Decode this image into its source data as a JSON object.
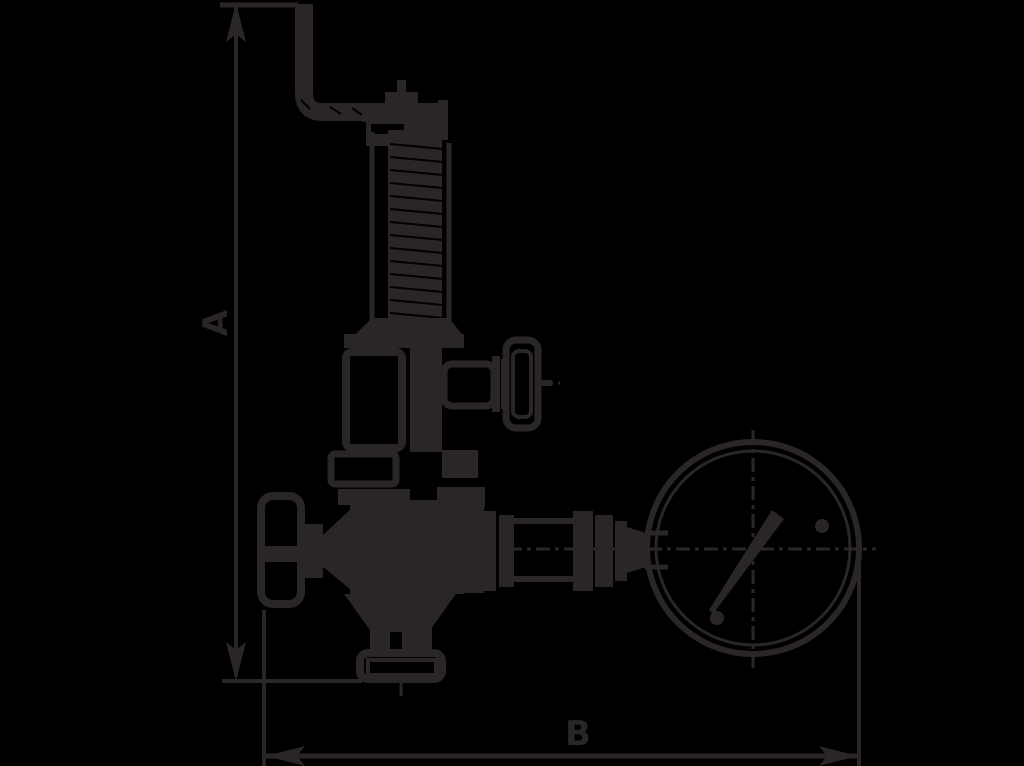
{
  "diagram": {
    "type": "technical-drawing",
    "labels": {
      "dim_vertical": "A",
      "dim_horizontal": "B"
    },
    "colors": {
      "background": "#000000",
      "line": "#2a2627"
    },
    "parts": [
      "lever-bracket",
      "valve-cap",
      "spring-bonnet",
      "side-valve-handwheel",
      "main-handwheel",
      "valve-body",
      "bottom-flange",
      "outlet-pipe",
      "pressure-gauge"
    ]
  }
}
